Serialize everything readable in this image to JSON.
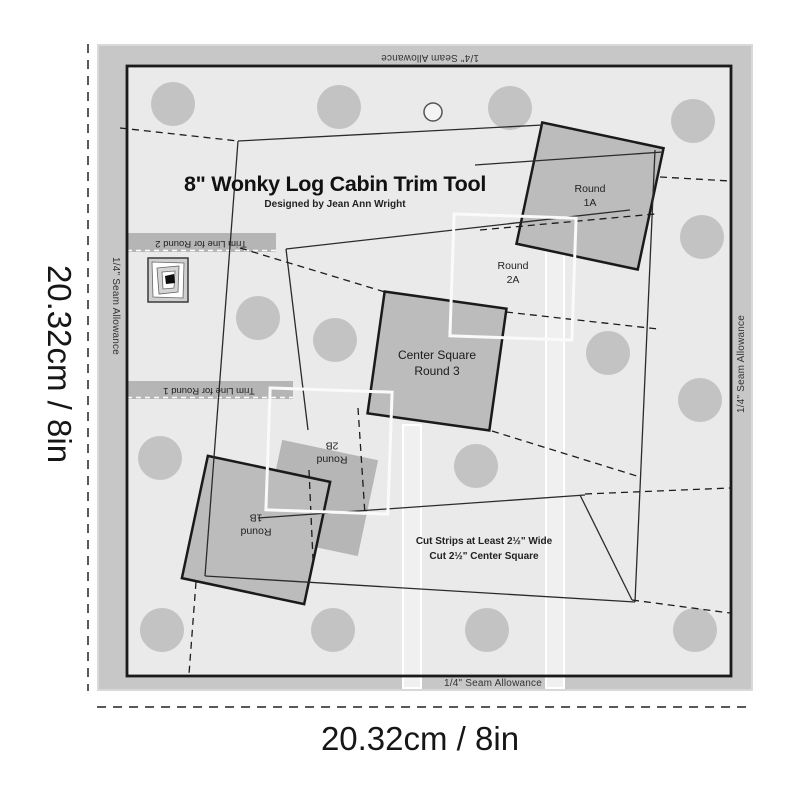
{
  "product": {
    "title": "8\" Wonky Log Cabin Trim Tool",
    "designer": "Designed by Jean Ann Wright"
  },
  "dimension_labels": {
    "left": "20.32cm / 8in",
    "bottom": "20.32cm / 8in"
  },
  "seam_allowance": {
    "top": "1/4\" Seam Allowance",
    "bottom": "1/4\" Seam Allowance",
    "left": "1/4\" Seam Allowance",
    "right": "1/4\" Seam Allowance"
  },
  "trim_lines": {
    "round2": "Trim Line for Round 2",
    "round1": "Trim Line for Round 1"
  },
  "regions": {
    "round_1a": "Round\n1A",
    "round_2a": "Round\n2A",
    "center_square": "Center Square\nRound 3",
    "round_2b": "Round\n2B",
    "round_1b": "Round\n1B"
  },
  "instructions": "Cut Strips at Least 2½\" Wide\nCut 2½\" Center Square",
  "icons": {
    "log_cabin_block": "log-cabin-block-icon"
  },
  "colors": {
    "ruler_ring": "#c7c7c7",
    "ruler_surface": "#eaeaea",
    "grip_dot": "#c3c3c3",
    "patch_square": "#bcbcbc",
    "trim_band": "#b5b5b5",
    "outline": "#1a1a1a"
  }
}
